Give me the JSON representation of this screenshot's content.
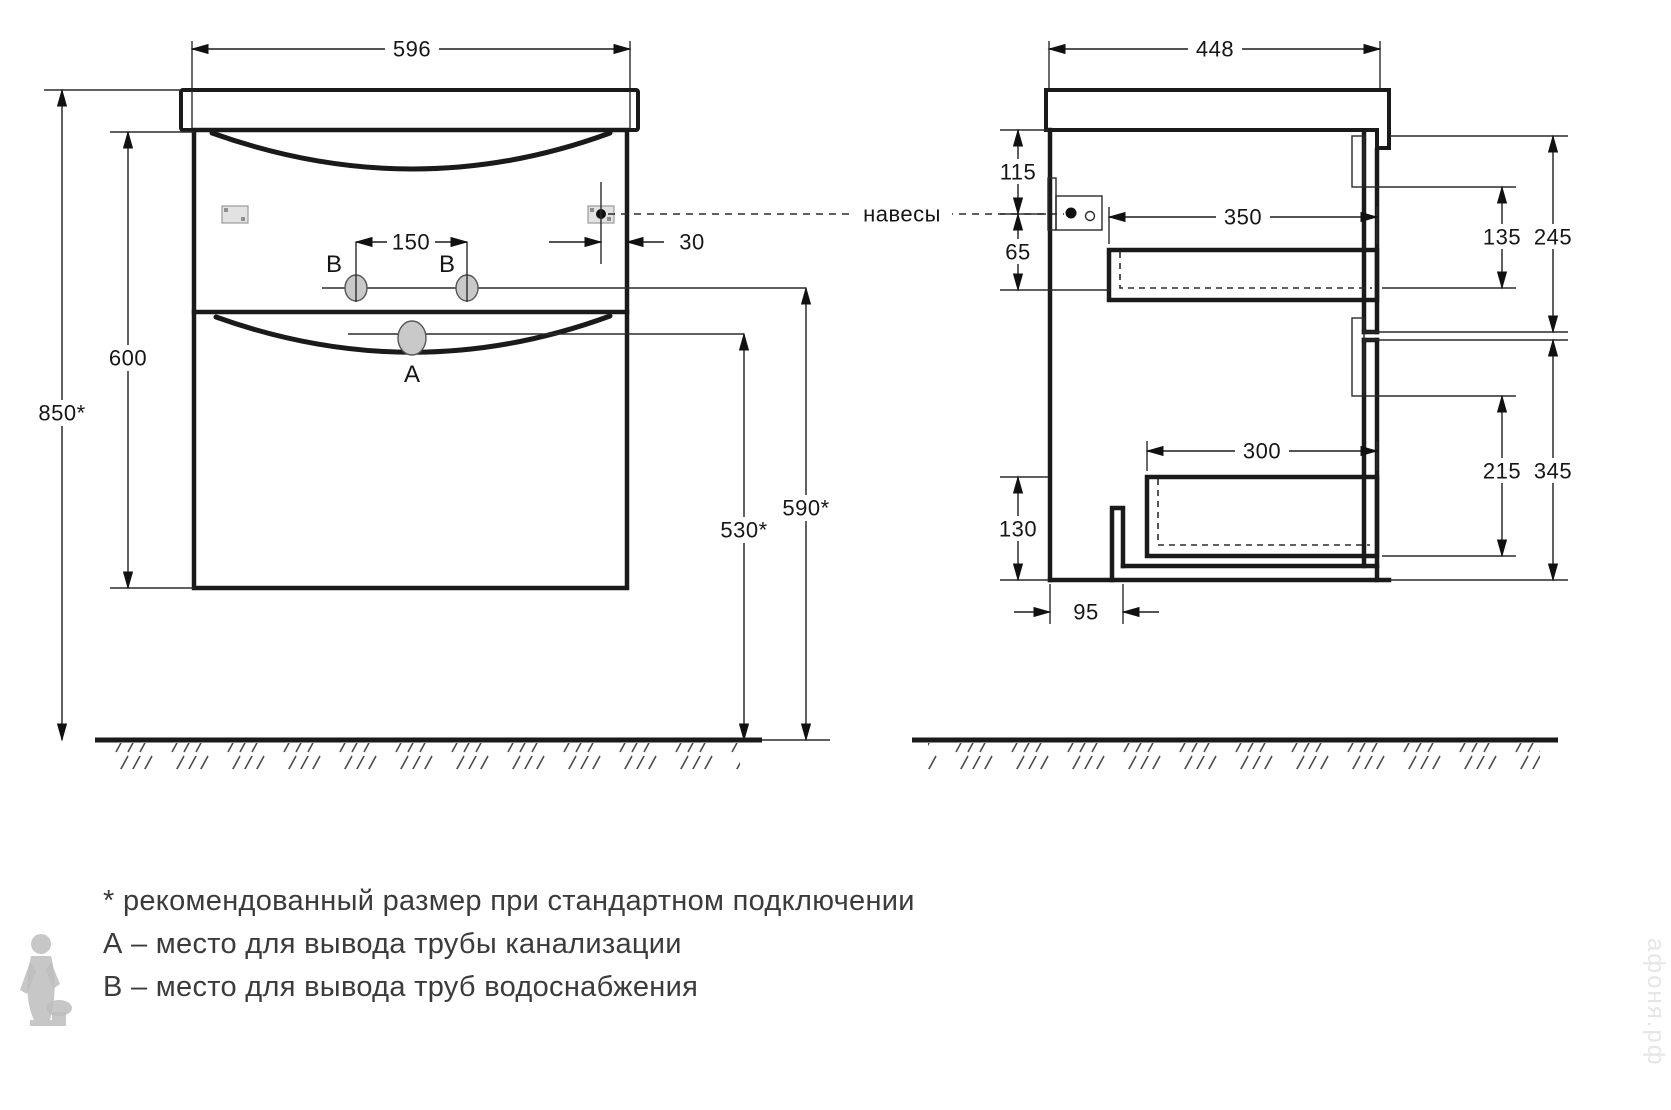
{
  "front": {
    "overall_width": "596",
    "cabinet_height": "600",
    "install_height": "850*",
    "faucet_spacing": "150",
    "hinge_inset": "30",
    "sewer_outlet_height": "530*",
    "water_outlet_height": "590*",
    "label_sewer": "A",
    "label_water_left": "B",
    "label_water_right": "B"
  },
  "side": {
    "overall_depth": "448",
    "hinge_from_top": "115",
    "hinge_below": "65",
    "upper_drawer_depth": "350",
    "upper_opening_height": "135",
    "upper_front_height": "245",
    "lower_drawer_depth": "300",
    "lower_opening_height": "215",
    "lower_front_height": "345",
    "bottom_offset": "130",
    "back_notch": "95"
  },
  "callout": {
    "hinges_label": "навесы"
  },
  "legend": {
    "note": "* рекомендованный размер при стандартном подключении",
    "a": "А – место для вывода трубы канализации",
    "b": "В – место для вывода труб водоснабжения"
  },
  "watermark": {
    "site": "афоня.рф"
  }
}
